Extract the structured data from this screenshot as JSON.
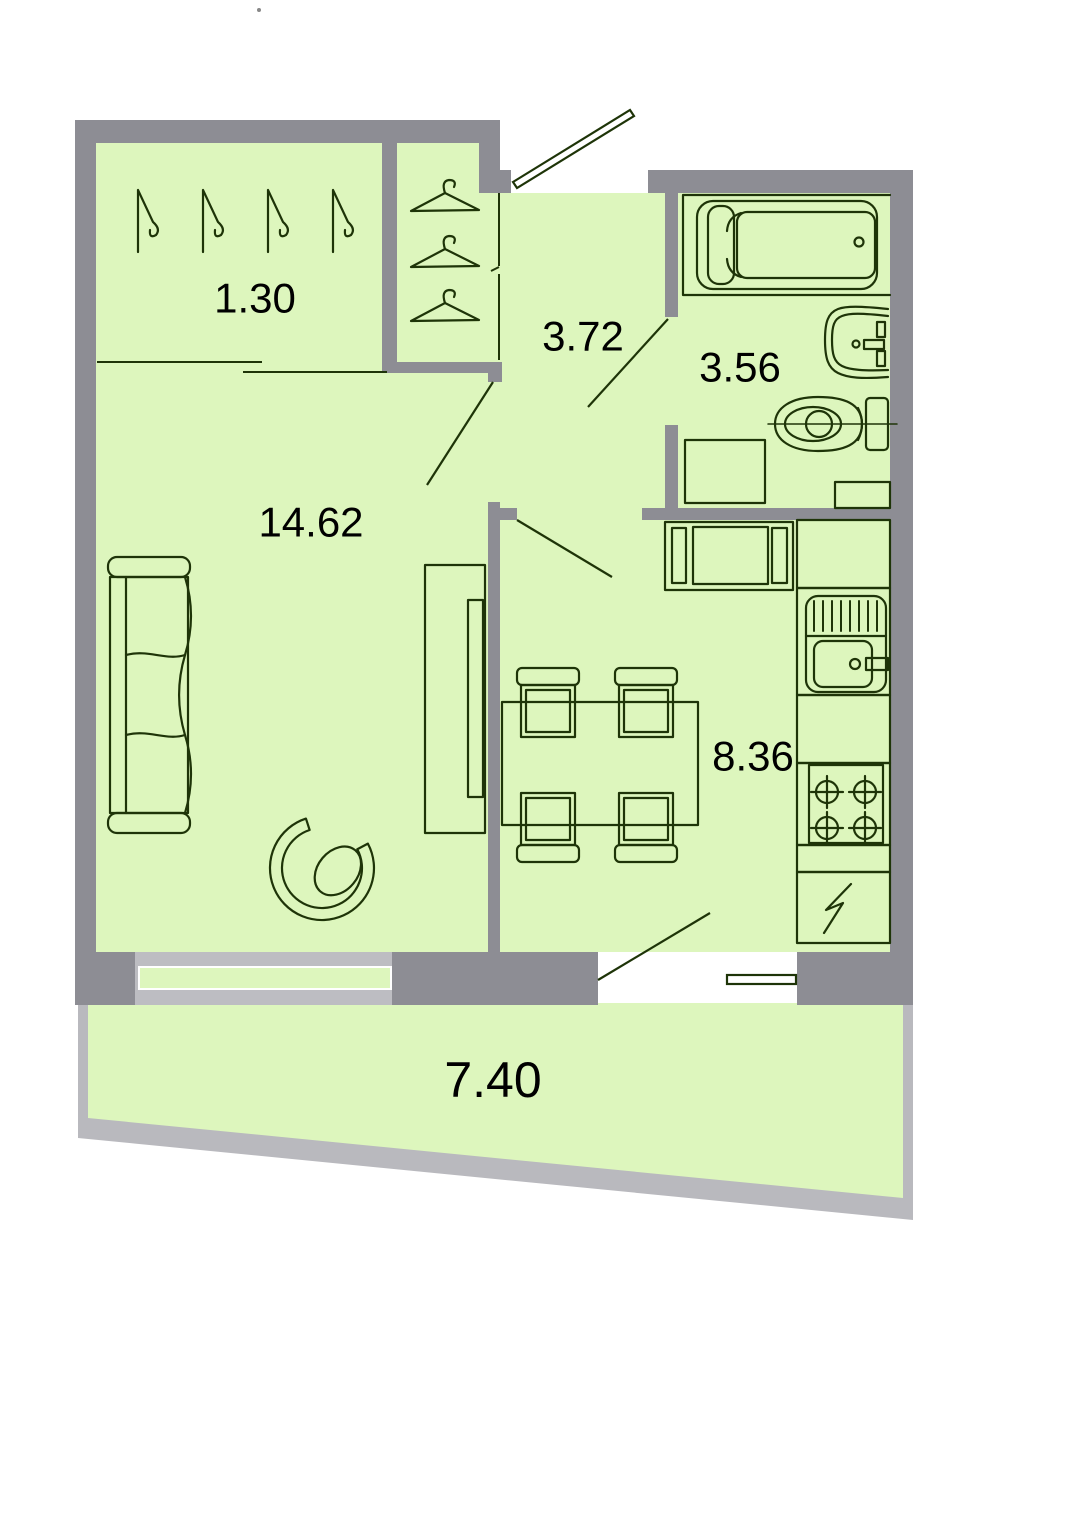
{
  "document": {
    "type": "apartment-floor-plan"
  },
  "colors": {
    "background": "#ffffff",
    "room_fill": "#ddf6bd",
    "wall": "#8d8d94",
    "balcony_wall": "#b9b9be",
    "window_frame": "#bdbdc2",
    "line": "#1e3408",
    "label_text": "#000000"
  },
  "rooms": [
    {
      "name": "closet",
      "area": "1.30"
    },
    {
      "name": "hallway",
      "area": "3.72"
    },
    {
      "name": "bathroom",
      "area": "3.56"
    },
    {
      "name": "living-room",
      "area": "14.62"
    },
    {
      "name": "kitchen",
      "area": "8.36"
    },
    {
      "name": "balcony",
      "area": "7.40"
    }
  ],
  "fixtures": [
    "entrance-door",
    "coat-hanger",
    "wardrobe-hanger",
    "sofa",
    "armchair",
    "tv-stand",
    "dining-table",
    "chair",
    "bathtub",
    "washbasin",
    "toilet",
    "washing-machine",
    "kitchen-sink",
    "stove",
    "refrigerator",
    "window",
    "balcony-door",
    "interior-door"
  ]
}
